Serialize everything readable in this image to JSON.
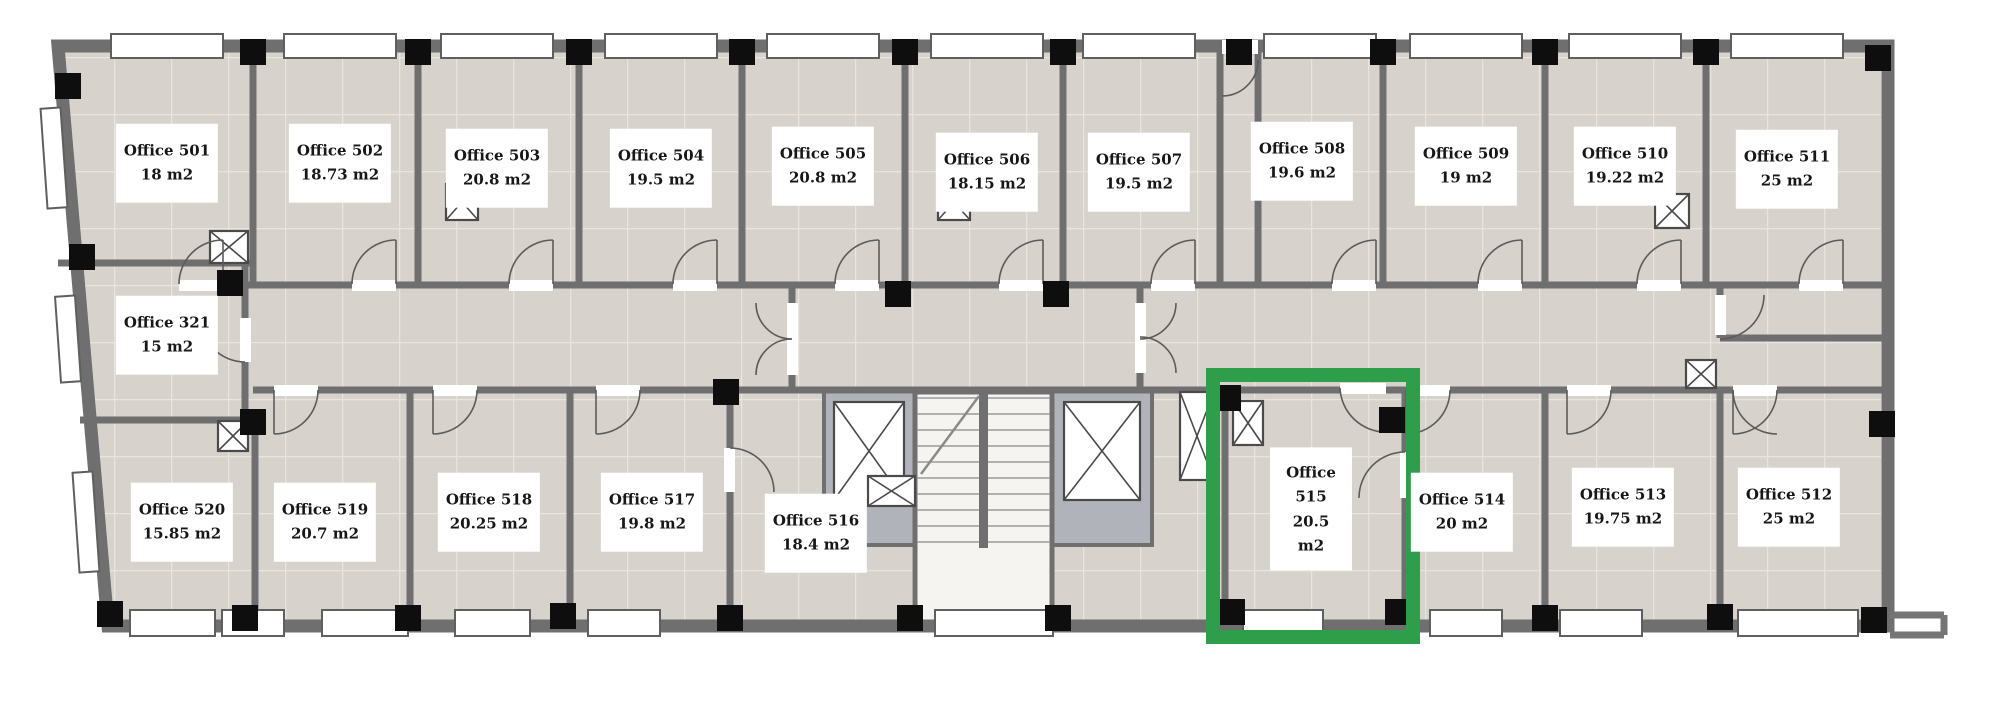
{
  "floorplan": {
    "title": "Office floor plan - level 5",
    "highlight_color": "#2e9e4a",
    "selected_room": "Office 515",
    "rooms": [
      {
        "id": "office-501",
        "name": "Office 501",
        "area": "18 m2"
      },
      {
        "id": "office-502",
        "name": "Office 502",
        "area": "18.73 m2"
      },
      {
        "id": "office-503",
        "name": "Office 503",
        "area": "20.8 m2"
      },
      {
        "id": "office-504",
        "name": "Office 504",
        "area": "19.5 m2"
      },
      {
        "id": "office-505",
        "name": "Office 505",
        "area": "20.8 m2"
      },
      {
        "id": "office-506",
        "name": "Office 506",
        "area": "18.15 m2"
      },
      {
        "id": "office-507",
        "name": "Office 507",
        "area": "19.5 m2"
      },
      {
        "id": "office-508",
        "name": "Office 508",
        "area": "19.6 m2"
      },
      {
        "id": "office-509",
        "name": "Office 509",
        "area": "19 m2"
      },
      {
        "id": "office-510",
        "name": "Office 510",
        "area": "19.22 m2"
      },
      {
        "id": "office-511",
        "name": "Office 511",
        "area": "25 m2"
      },
      {
        "id": "office-321",
        "name": "Office 321",
        "area": "15 m2"
      },
      {
        "id": "office-520",
        "name": "Office 520",
        "area": "15.85 m2"
      },
      {
        "id": "office-519",
        "name": "Office 519",
        "area": "20.7 m2"
      },
      {
        "id": "office-518",
        "name": "Office 518",
        "area": "20.25 m2"
      },
      {
        "id": "office-517",
        "name": "Office 517",
        "area": "19.8 m2"
      },
      {
        "id": "office-516",
        "name": "Office 516",
        "area": "18.4 m2"
      },
      {
        "id": "office-515",
        "name": "Office 515",
        "area": "20.5 m2",
        "selected": true,
        "stacked": true
      },
      {
        "id": "office-514",
        "name": "Office 514",
        "area": "20 m2"
      },
      {
        "id": "office-513",
        "name": "Office 513",
        "area": "19.75 m2"
      },
      {
        "id": "office-512",
        "name": "Office 512",
        "area": "25 m2"
      }
    ]
  },
  "colors": {
    "floor_tile": "#d7d3cc",
    "tile_grout": "#e8e5df",
    "wall": "#6f6f6f",
    "column": "#0e0e0e",
    "window": "#ffffff",
    "elevator_surround": "#b0b4ba",
    "stair": "#f5f4f1",
    "highlight": "#2e9e4a"
  }
}
